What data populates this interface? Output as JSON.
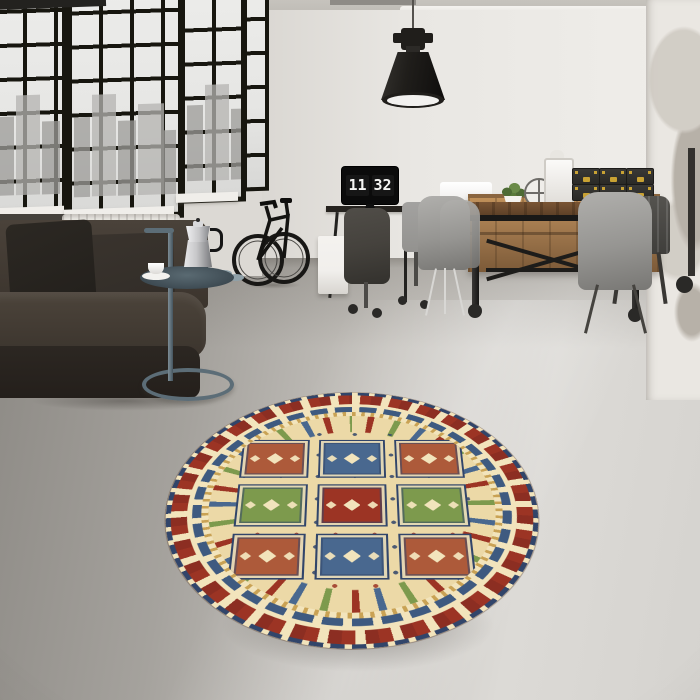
{
  "scene": {
    "description": "Industrial loft interior with black-framed windows, dark leather sofa, bicycle, desk with flip-clock monitor, wooden dining set and a round Kazak-style panel rug on polished concrete floor"
  },
  "clock": {
    "hours": "11",
    "minutes": "32"
  },
  "palette": {
    "ceiling": "#c6c3bd",
    "ceiling2": "#b6b3ad",
    "wall": "#e9e7e3",
    "wall-shade": "#d9d6d1",
    "window-frame": "#17160f",
    "sky": "#e6e6e4",
    "city": "#b5b4b1",
    "city2": "#9d9c99",
    "mullion": "#dcd9d4",
    "sill": "#f0eeea",
    "brick-dark": "#45423d",
    "radiator": "#eceae5",
    "floor-dark": "#8d8a85",
    "floor-mid": "#c6c3be",
    "floor-light": "#dcdad6",
    "sofa": "#3b342d",
    "sofa-light": "#4a423a",
    "sofa-dark": "#2c2722",
    "pillow": "#23201c",
    "pillow2": "#322d28",
    "table-metal": "#5c6d77",
    "tray": "#3e4b53",
    "moka": "#c7c7c9",
    "desk": "#26231f",
    "cabinet": "#f1efec",
    "hoodie": "#45423d",
    "chair-office": "#93928f",
    "monitor": "#0b0b0b",
    "clock-bg": "#161616",
    "clock-text": "#f5f5f3",
    "wood": "#a97f52",
    "wood-dark": "#7c5a38",
    "table-wood": "#5e4128",
    "box": "#2b2a27",
    "brass": "#c9a233",
    "shell": "#969592",
    "tolix": "#3f3e3b",
    "column": "#eae7e2",
    "column-patch": "#cdc8c0",
    "column-patch2": "#aba49a",
    "lamp": "#201e1b",
    "lamp-rim": "#f2f1ef",
    "cord": "#55524e",
    "pipe": "#eeece8",
    "conduit": "#23221f",
    "plant": "#4e6b35",
    "rug-cream": "#ecd9a7",
    "rug-cream2": "#f2e4bc",
    "rug-red": "#9c3424",
    "rug-red2": "#8c2e22",
    "rug-rust": "#ad5a3a",
    "rug-blue": "#49688f",
    "rug-blue2": "#3e5a80",
    "rug-green": "#7d9a4d",
    "rug-navy": "#31456a",
    "rug-gold": "#c9a254"
  },
  "rug": {
    "shape": "round",
    "style": "kazak-panel",
    "grid": [
      [
        "rust",
        "blue",
        "rust"
      ],
      [
        "green",
        "red",
        "green"
      ],
      [
        "rust",
        "blue",
        "rust"
      ]
    ]
  }
}
